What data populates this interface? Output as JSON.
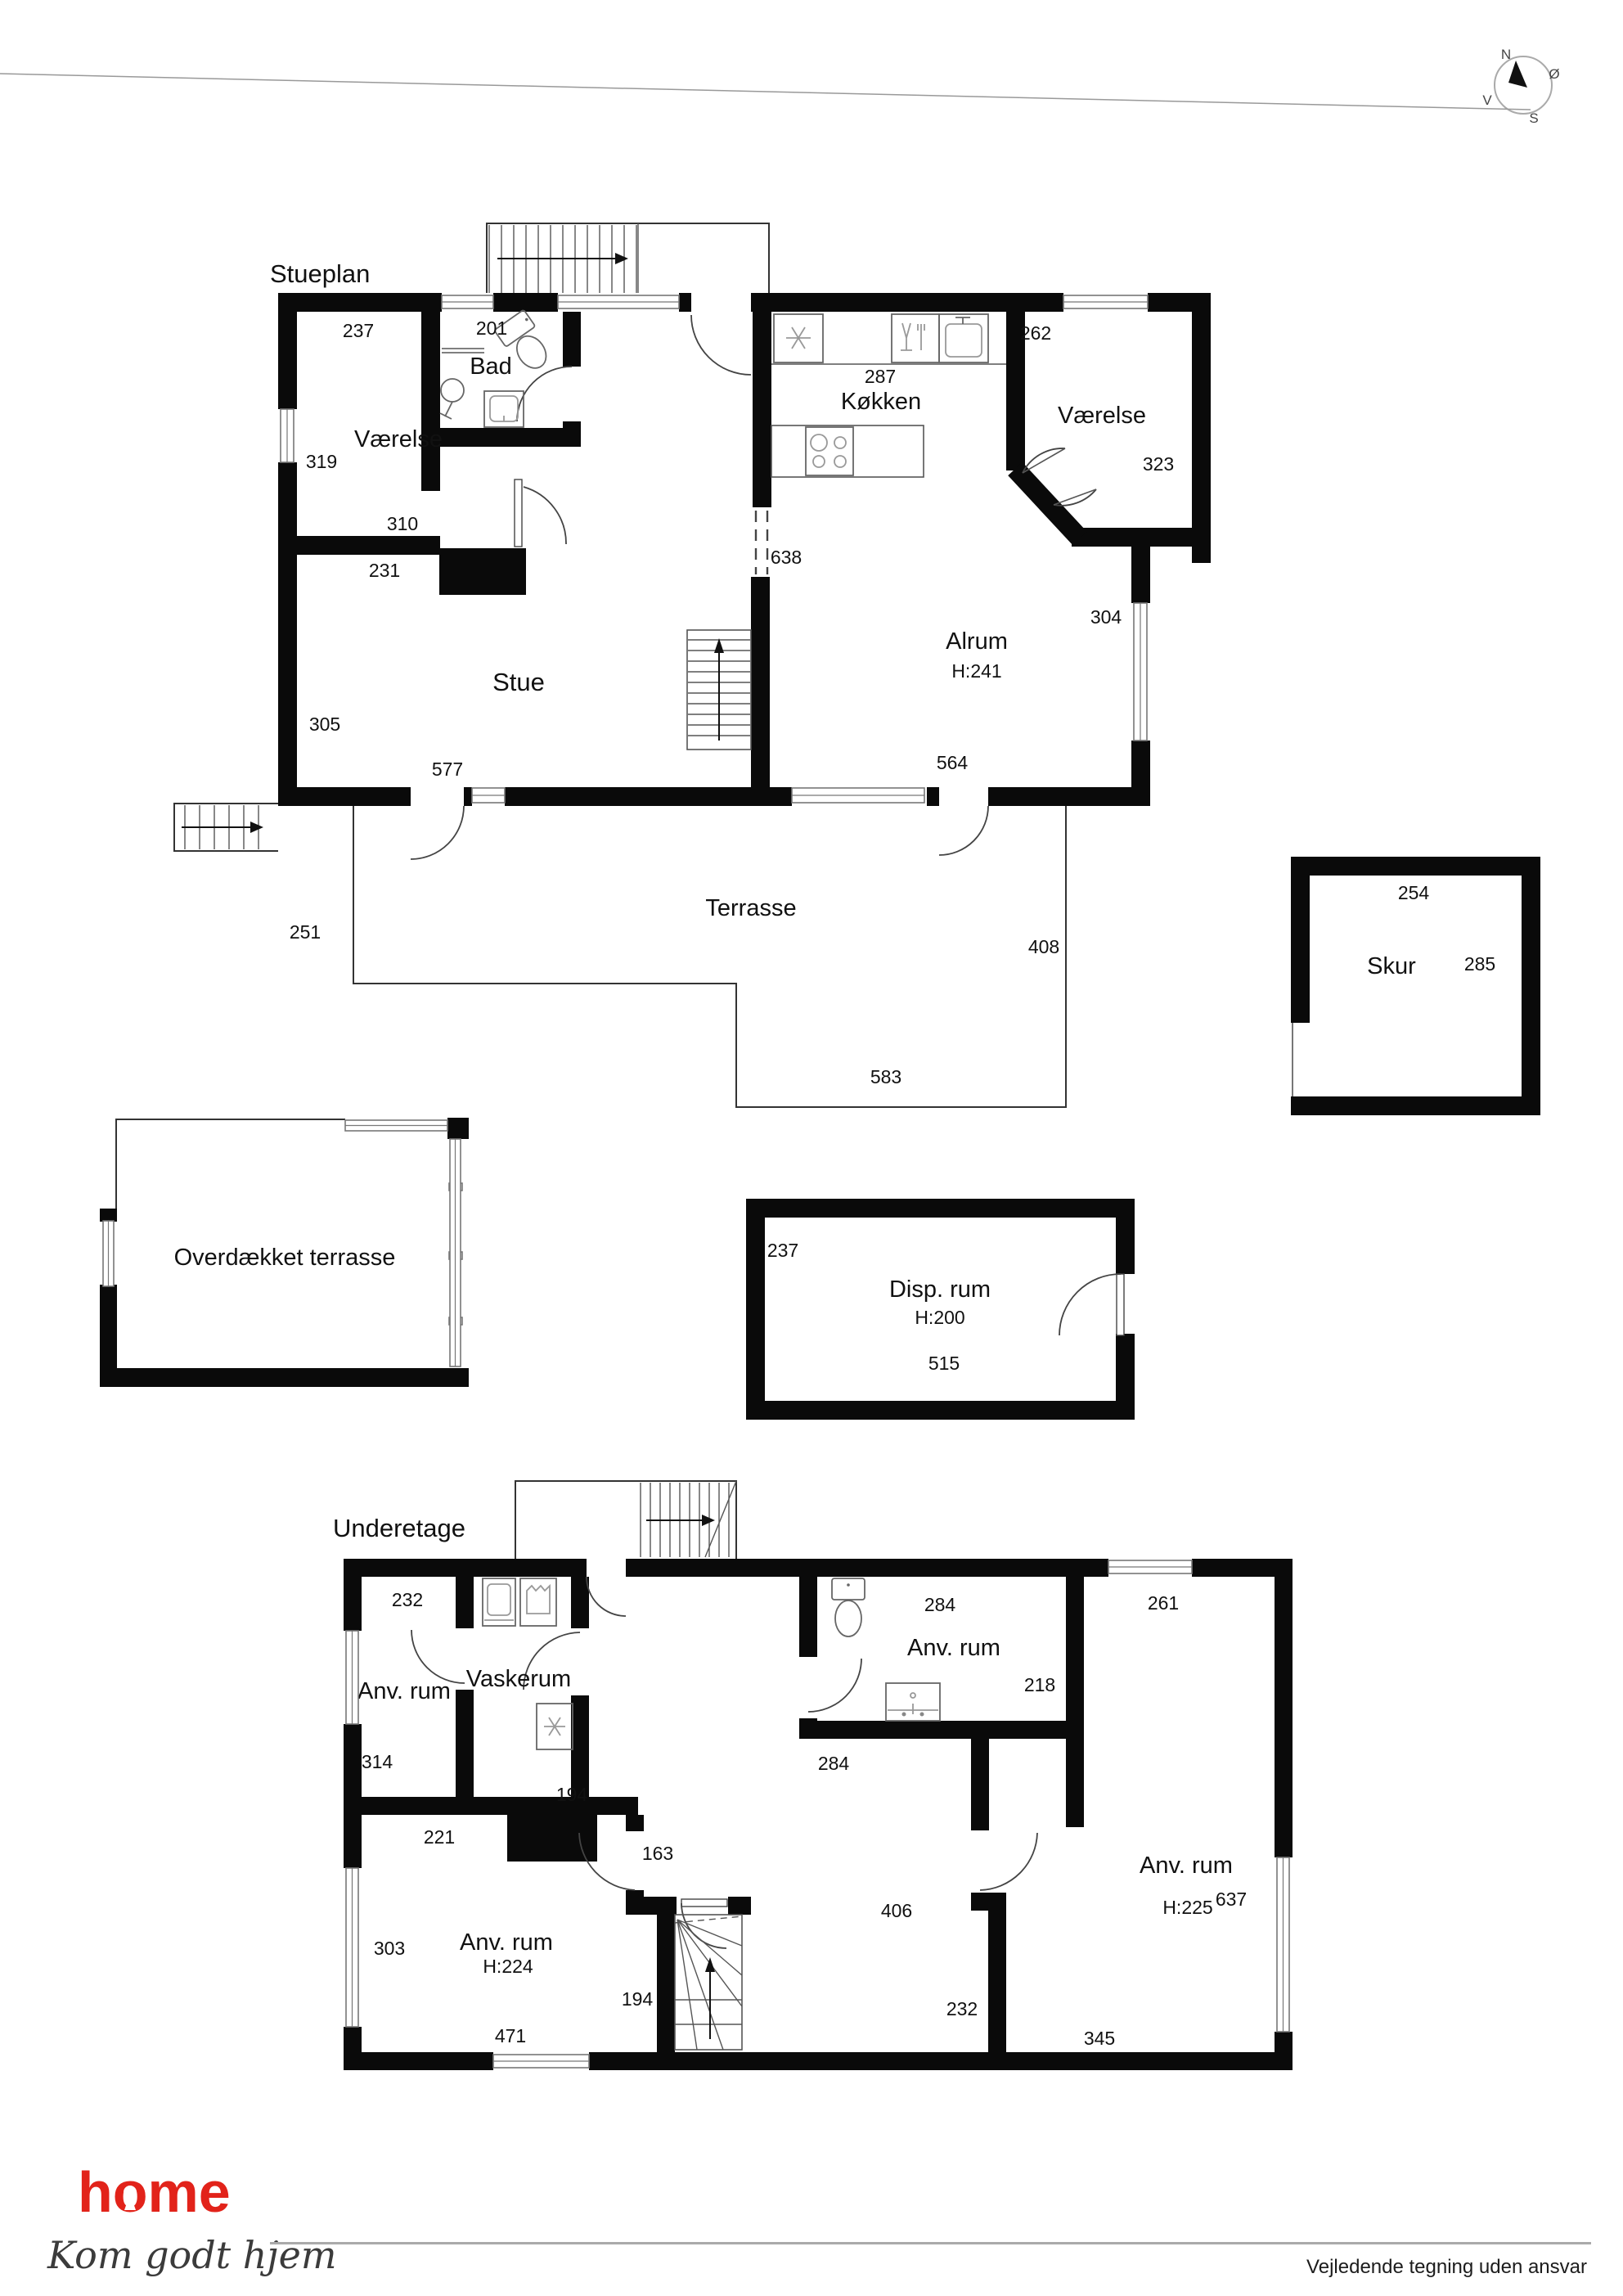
{
  "document": {
    "footer": {
      "disclaimer": "Vejledende tegning uden ansvar"
    },
    "brand": {
      "logo": "home",
      "tagline": "Kom godt hjem",
      "logo_color": "#e2231a"
    }
  },
  "compass": {
    "north": "N",
    "east": "Ø",
    "south": "S",
    "west": "V"
  },
  "stueplan": {
    "title": "Stueplan",
    "rooms": {
      "vaerelse_nw": "Værelse",
      "bad": "Bad",
      "koekken": "Køkken",
      "vaerelse_ne": "Værelse",
      "alrum": "Alrum",
      "alrum_h": "H:241",
      "stue": "Stue",
      "terrasse": "Terrasse",
      "skur": "Skur"
    },
    "dims": {
      "d237": "237",
      "d201": "201",
      "d287": "287",
      "d262": "262",
      "d319": "319",
      "d310": "310",
      "d231": "231",
      "d323": "323",
      "d638": "638",
      "d304": "304",
      "d305": "305",
      "d577": "577",
      "d564": "564",
      "d251": "251",
      "d408": "408",
      "d583": "583",
      "d254": "254",
      "d285": "285"
    }
  },
  "mellemplan": {
    "rooms": {
      "overdaekket": "Overdækket terrasse",
      "disp": "Disp. rum",
      "disp_h": "H:200"
    },
    "dims": {
      "d237": "237",
      "d515": "515"
    }
  },
  "underetage": {
    "title": "Underetage",
    "rooms": {
      "anv_nw": "Anv. rum",
      "vaskerum": "Vaskerum",
      "anv_mid": "Anv. rum",
      "anv_e": "Anv. rum",
      "anv_e_h": "H:225",
      "anv_sw": "Anv. rum",
      "anv_sw_h": "H:224"
    },
    "dims": {
      "d232a": "232",
      "d284a": "284",
      "d261": "261",
      "d314": "314",
      "d218": "218",
      "d284b": "284",
      "d194a": "194",
      "d221": "221",
      "d163": "163",
      "d406": "406",
      "d303": "303",
      "d194b": "194",
      "d232b": "232",
      "d345": "345",
      "d637": "637",
      "d471": "471"
    }
  }
}
